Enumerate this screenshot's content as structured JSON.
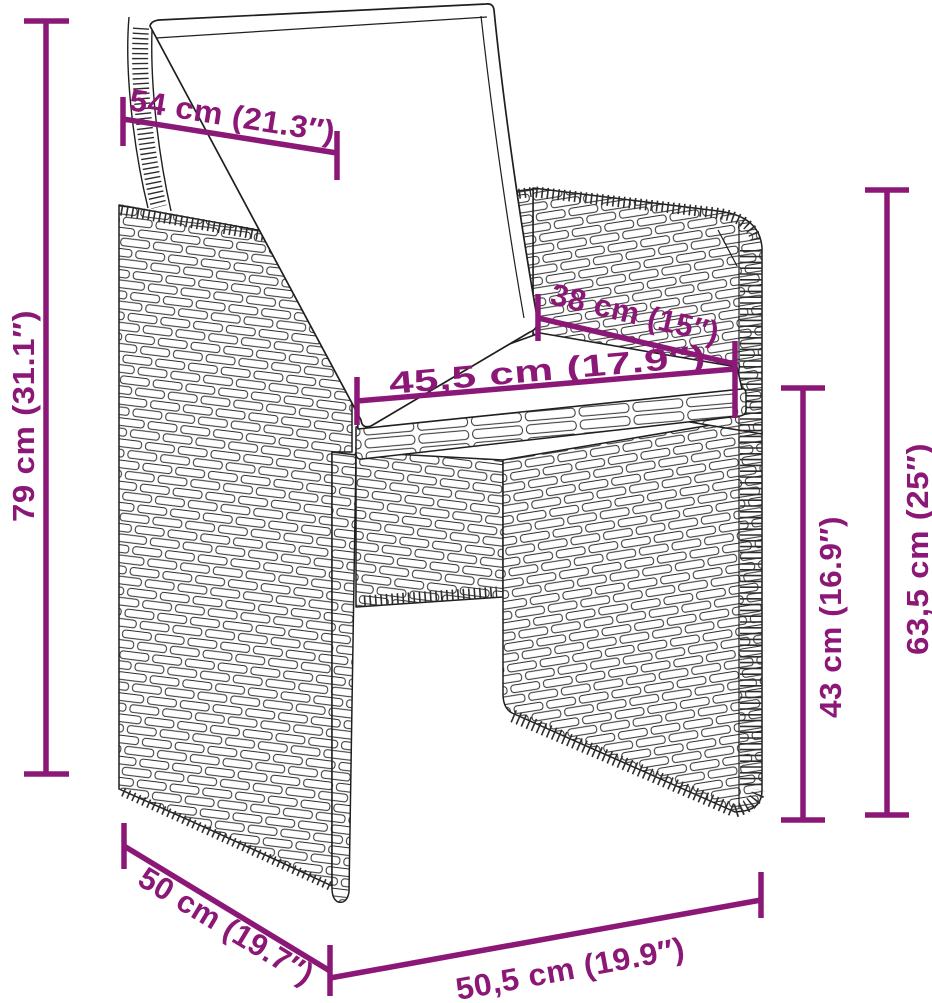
{
  "meta": {
    "type": "product-dimension-diagram",
    "background_color": "#ffffff",
    "line_color": "#1f1f1f",
    "dimension_color": "#8B1877"
  },
  "product": {
    "name": "poly-rattan cube dining chair with back and seat cushions"
  },
  "dimensions": {
    "backrest_width": {
      "label": "54 cm (21.3″)"
    },
    "total_height": {
      "label": "79 cm (31.1″)"
    },
    "seat_depth": {
      "label": "38 cm (15″)"
    },
    "seat_width": {
      "label": "45,5 cm (17.9″)"
    },
    "seat_height": {
      "label": "43 cm (16.9″)"
    },
    "armrest_height": {
      "label": "63,5 cm (25″)"
    },
    "base_depth": {
      "label": "50 cm (19.7″)"
    },
    "base_width": {
      "label": "50,5 cm (19.9″)"
    }
  }
}
